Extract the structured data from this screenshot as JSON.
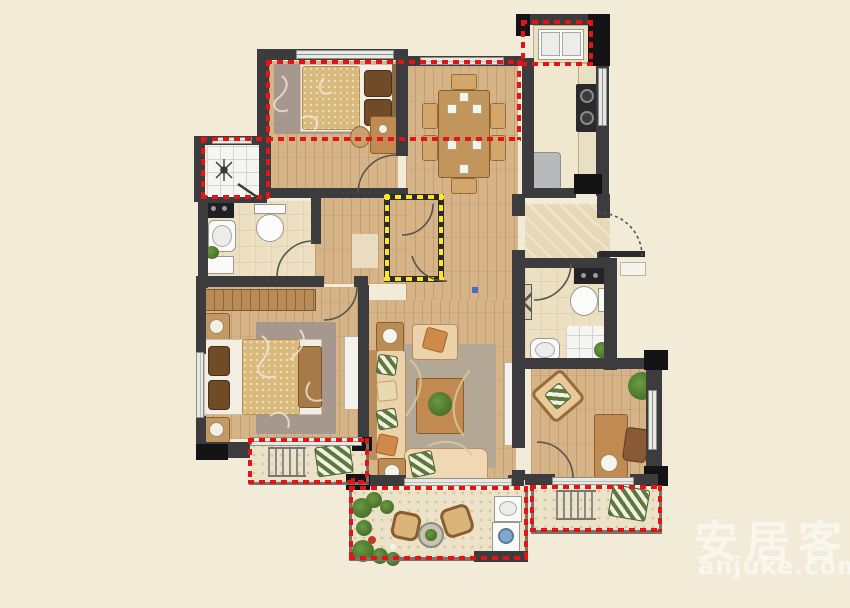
{
  "watermark": {
    "brand": "安居客",
    "domain": "anjuke.com"
  },
  "colors": {
    "background": "#f2ebd8",
    "wall": "#3c3b3d",
    "wall_black": "#141416",
    "wood": "#d6b488",
    "cream_floor": "#f0e8ce",
    "bath_floor": "#ecdfc2",
    "marble": "#e7d9b6",
    "balcony_floor": "#ece2c8",
    "rug": "#a6988f",
    "rug_living": "#b3a896",
    "bed_quilt": "#d9ba7c",
    "pillow_brown": "#6f4b28",
    "sofa": "#ecd2ab",
    "sofa_frame": "#b98e5c",
    "wood_furniture": "#c08a50",
    "accent_red": "#e51414",
    "accent_yellow": "#ffe71c",
    "appliance_white": "#fafaf8",
    "washer_drum": "#7fa8cc",
    "fridge": "#b8b9bb",
    "stove": "#2a2a2c",
    "watermark": "rgba(255,255,255,0.55)",
    "marker_blue": "#3f6fd1"
  },
  "regions": [
    "bedroom-top-left",
    "dining-area",
    "kitchen",
    "shower-room",
    "bathroom-1",
    "hallway",
    "storage-highlight",
    "entry-foyer",
    "bathroom-2",
    "master-bedroom",
    "living-room",
    "study",
    "master-balcony",
    "living-balcony",
    "study-balcony"
  ]
}
